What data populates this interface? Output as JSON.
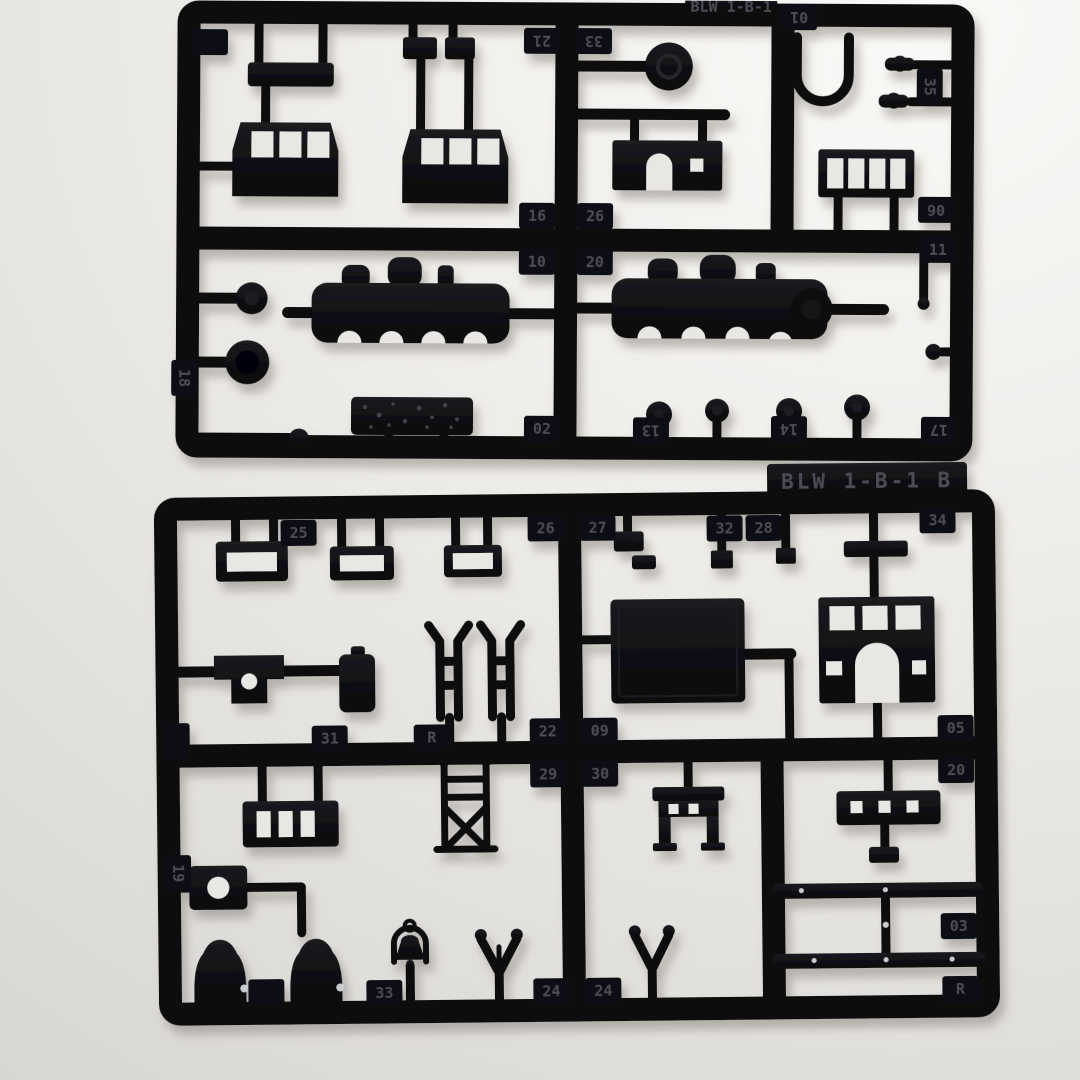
{
  "scene": {
    "description": "Two black injection-molded plastic model kit sprues with locomotive parts photographed on a light gray surface",
    "surface_color": "#ebe9e6",
    "plastic_color": "#0c0c0f",
    "emboss_text_color": "#4b4b55"
  },
  "sprues": [
    {
      "id": "top",
      "label_fragment": "BLW 1-B-1",
      "parts": [
        "equipment-bar",
        "clip",
        "cab-side-panel",
        "cab-side-panel",
        "cab-front-panel",
        "dome-cap",
        "handrail-loop",
        "wing-nut",
        "wing-nut",
        "four-pane-window-frame",
        "boiler-shell-half",
        "boiler-shell-half",
        "dome-top",
        "cylinder-cap",
        "ball-detail",
        "coal-load-block",
        "round-knob",
        "round-knob",
        "round-knob",
        "round-knob",
        "pin",
        "ball-detail"
      ],
      "tabs": [
        {
          "n": "01",
          "x": 798,
          "y": 16,
          "rot": 180
        },
        {
          "n": "21",
          "x": 541,
          "y": 41,
          "rot": 180
        },
        {
          "n": "33",
          "x": 593,
          "y": 41,
          "rot": 180
        },
        {
          "n": "",
          "x": 209,
          "y": 44,
          "rot": 0
        },
        {
          "n": "35",
          "x": 929,
          "y": 85,
          "rot": 90
        },
        {
          "n": "06",
          "x": 936,
          "y": 208,
          "rot": 180
        },
        {
          "n": "11",
          "x": 938,
          "y": 248,
          "rot": 0
        },
        {
          "n": "16",
          "x": 537,
          "y": 216,
          "rot": 0
        },
        {
          "n": "26",
          "x": 595,
          "y": 216,
          "rot": 0
        },
        {
          "n": "10",
          "x": 537,
          "y": 262,
          "rot": 0
        },
        {
          "n": "20",
          "x": 595,
          "y": 262,
          "rot": 0
        },
        {
          "n": "18",
          "x": 185,
          "y": 380,
          "rot": 90
        },
        {
          "n": "02",
          "x": 543,
          "y": 429,
          "rot": 0
        },
        {
          "n": "13",
          "x": 652,
          "y": 430,
          "rot": 180
        },
        {
          "n": "14",
          "x": 790,
          "y": 428,
          "rot": 180
        },
        {
          "n": "17",
          "x": 940,
          "y": 428,
          "rot": 180
        }
      ]
    },
    {
      "id": "bottom",
      "label": "BLW 1-B-1 B",
      "parts": [
        "window-frame",
        "window-frame",
        "window-frame",
        "bracket-with-hole",
        "tank-canister",
        "ladder-stile",
        "ladder-stile",
        "clip",
        "clip",
        "square-block",
        "square-block",
        "low-bar",
        "roof-panel",
        "cab-front-arch-panel",
        "number-plate-with-hole",
        "step-ladder",
        "truss-frame",
        "bell-with-yoke",
        "steam-dome",
        "steam-dome",
        "pilot-fork",
        "pilot-fork",
        "bench-step",
        "grab-iron-bar",
        "elbow-bracket",
        "pin",
        "running-board-bar",
        "running-board-bar"
      ],
      "tabs": [
        {
          "n": "25",
          "x": 301,
          "y": 530,
          "rot": 0
        },
        {
          "n": "26",
          "x": 548,
          "y": 528,
          "rot": 0
        },
        {
          "n": "27",
          "x": 600,
          "y": 528,
          "rot": 0
        },
        {
          "n": "32",
          "x": 727,
          "y": 530,
          "rot": 0
        },
        {
          "n": "28",
          "x": 766,
          "y": 530,
          "rot": 0
        },
        {
          "n": "34",
          "x": 940,
          "y": 524,
          "rot": 0
        },
        {
          "n": "",
          "x": 177,
          "y": 737,
          "rot": 90
        },
        {
          "n": "31",
          "x": 330,
          "y": 736,
          "rot": 0
        },
        {
          "n": "R",
          "x": 432,
          "y": 736,
          "rot": 0
        },
        {
          "n": "22",
          "x": 548,
          "y": 731,
          "rot": 0
        },
        {
          "n": "09",
          "x": 600,
          "y": 731,
          "rot": 0
        },
        {
          "n": "29",
          "x": 548,
          "y": 774,
          "rot": 0
        },
        {
          "n": "30",
          "x": 600,
          "y": 774,
          "rot": 0
        },
        {
          "n": "05",
          "x": 956,
          "y": 732,
          "rot": 0
        },
        {
          "n": "20",
          "x": 956,
          "y": 774,
          "rot": 0
        },
        {
          "n": "19",
          "x": 177,
          "y": 869,
          "rot": 90
        },
        {
          "n": "",
          "x": 264,
          "y": 989,
          "rot": 0
        },
        {
          "n": "33",
          "x": 382,
          "y": 991,
          "rot": 0
        },
        {
          "n": "24",
          "x": 549,
          "y": 991,
          "rot": 0
        },
        {
          "n": "24",
          "x": 601,
          "y": 991,
          "rot": 0
        },
        {
          "n": "03",
          "x": 957,
          "y": 930,
          "rot": 0
        },
        {
          "n": "R",
          "x": 958,
          "y": 993,
          "rot": 0
        }
      ]
    }
  ]
}
